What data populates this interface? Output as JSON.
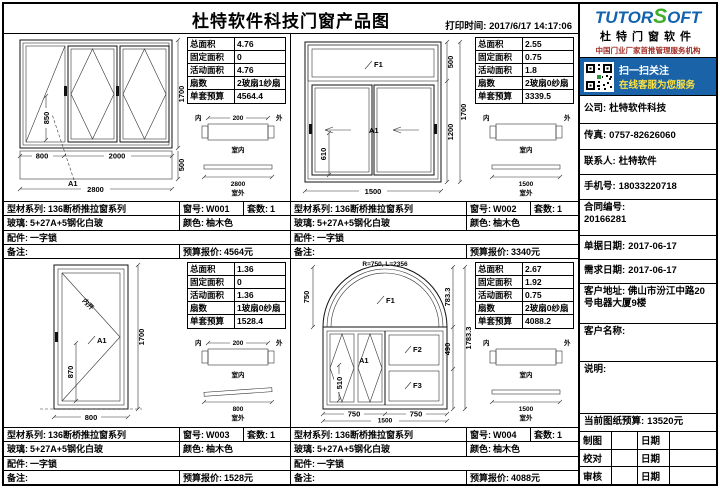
{
  "header": {
    "title": "杜特软件科技门窗产品图",
    "print_label": "打印时间:",
    "print_time": "2017/6/17 14:17:06"
  },
  "logo": {
    "brand1": "TUTOR",
    "brand2": "S",
    "brand3": "OFT",
    "subtitle": "杜特门窗软件",
    "tagline": "中国门业厂家首推管理服务机构",
    "qr1": "扫一扫关注",
    "qr2": "在线客服为您服务"
  },
  "sidebar": {
    "company_label": "公司:",
    "company": "杜特软件科技",
    "fax_label": "传真:",
    "fax": "0757-82626060",
    "contact_label": "联系人:",
    "contact": "杜特软件",
    "mobile_label": "手机号:",
    "mobile": "18033220718",
    "contract_label": "合同编号:",
    "contract": "20166281",
    "order_date_label": "单据日期:",
    "order_date": "2017-06-17",
    "need_date_label": "需求日期:",
    "need_date": "2017-06-17",
    "address_label": "客户地址:",
    "address": "佛山市汾江中路20号电器大厦9楼",
    "customer_label": "客户名称:",
    "customer": "",
    "note_label": "说明:",
    "note": "",
    "budget_label": "当前图纸预算:",
    "budget": "13520元",
    "signs": [
      {
        "role": "制图",
        "date": "日期"
      },
      {
        "role": "校对",
        "date": "日期"
      },
      {
        "role": "审核",
        "date": "日期"
      }
    ]
  },
  "windows": [
    {
      "spec": [
        {
          "l": "总面积",
          "v": "4.76"
        },
        {
          "l": "固定面积",
          "v": "0"
        },
        {
          "l": "活动面积",
          "v": "4.76"
        },
        {
          "l": "扇数",
          "v": "2玻扇1纱扇"
        },
        {
          "l": "单套预算",
          "v": "4564.4"
        }
      ],
      "info": {
        "series_l": "型材系列:",
        "series": "136断桥推拉窗系列",
        "no_l": "窗号:",
        "no": "W001",
        "sets_l": "套数:",
        "sets": "1",
        "glass_l": "玻璃:",
        "glass": "5+27A+5钢化白玻",
        "color_l": "颜色:",
        "color": "柚木色",
        "parts_l": "配件:",
        "parts": "一字锁",
        "remark_l": "备注:",
        "remark": "",
        "quote_l": "预算报价:",
        "quote": "4564元"
      },
      "dims": {
        "w1": "800",
        "w2": "2000",
        "w": "2800",
        "h": "1700",
        "sill": "500",
        "ih": "850",
        "tag": "A1"
      },
      "detail": {
        "in": "内",
        "out": "外",
        "depth": "200",
        "room_in": "室内",
        "plan": "2800",
        "room_out": "室外"
      }
    },
    {
      "spec": [
        {
          "l": "总面积",
          "v": "2.55"
        },
        {
          "l": "固定面积",
          "v": "0.75"
        },
        {
          "l": "活动面积",
          "v": "1.8"
        },
        {
          "l": "扇数",
          "v": "2玻扇0纱扇"
        },
        {
          "l": "单套预算",
          "v": "3339.5"
        }
      ],
      "info": {
        "series_l": "型材系列:",
        "series": "136断桥推拉窗系列",
        "no_l": "窗号:",
        "no": "W002",
        "sets_l": "套数:",
        "sets": "1",
        "glass_l": "玻璃:",
        "glass": "5+27A+5钢化白玻",
        "color_l": "颜色:",
        "color": "柚木色",
        "parts_l": "配件:",
        "parts": "一字锁",
        "remark_l": "备注:",
        "remark": "",
        "quote_l": "预算报价:",
        "quote": "3340元"
      },
      "dims": {
        "f1": "F1",
        "th": "500",
        "sh": "1200",
        "h": "1700",
        "w": "1500",
        "ih": "610",
        "tag": "A1"
      },
      "detail": {
        "in": "内",
        "out": "外",
        "depth": "",
        "room_in": "室内",
        "plan": "1500",
        "room_out": "室外"
      }
    },
    {
      "spec": [
        {
          "l": "总面积",
          "v": "1.36"
        },
        {
          "l": "固定面积",
          "v": "0"
        },
        {
          "l": "活动面积",
          "v": "1.36"
        },
        {
          "l": "扇数",
          "v": "1玻扇0纱扇"
        },
        {
          "l": "单套预算",
          "v": "1528.4"
        }
      ],
      "info": {
        "series_l": "型材系列:",
        "series": "136断桥推拉窗系列",
        "no_l": "窗号:",
        "no": "W003",
        "sets_l": "套数:",
        "sets": "1",
        "glass_l": "玻璃:",
        "glass": "5+27A+5钢化白玻",
        "color_l": "颜色:",
        "color": "柚木色",
        "parts_l": "配件:",
        "parts": "一字锁",
        "remark_l": "备注:",
        "remark": "",
        "quote_l": "预算报价:",
        "quote": "1528元"
      },
      "dims": {
        "w": "800",
        "h": "1700",
        "ih": "870",
        "tag": "A1",
        "open": "内开"
      },
      "detail": {
        "in": "内",
        "out": "外",
        "depth": "200",
        "room_in": "室内",
        "plan": "800",
        "room_out": "室外"
      }
    },
    {
      "spec": [
        {
          "l": "总面积",
          "v": "2.67"
        },
        {
          "l": "固定面积",
          "v": "1.92"
        },
        {
          "l": "活动面积",
          "v": "0.75"
        },
        {
          "l": "扇数",
          "v": "2玻扇0纱扇"
        },
        {
          "l": "单套预算",
          "v": "4088.2"
        }
      ],
      "info": {
        "series_l": "型材系列:",
        "series": "136断桥推拉窗系列",
        "no_l": "窗号:",
        "no": "W004",
        "sets_l": "套数:",
        "sets": "1",
        "glass_l": "玻璃:",
        "glass": "5+27A+5钢化白玻",
        "color_l": "颜色:",
        "color": "柚木色",
        "parts_l": "配件:",
        "parts": "一字锁",
        "remark_l": "备注:",
        "remark": "",
        "quote_l": "预算报价:",
        "quote": "4088元"
      },
      "dims": {
        "arc": "R=750, L=2356",
        "f1": "F1",
        "f2": "F2",
        "f3": "F3",
        "lh": "750",
        "s1": "783.3",
        "s2": "490",
        "h": "1783.3",
        "ih": "510",
        "w1": "750",
        "w2": "750",
        "w": "1500",
        "tag": "A1"
      },
      "detail": {
        "in": "内",
        "out": "外",
        "depth": "",
        "room_in": "室内",
        "plan": "1500",
        "room_out": "室外"
      }
    }
  ]
}
